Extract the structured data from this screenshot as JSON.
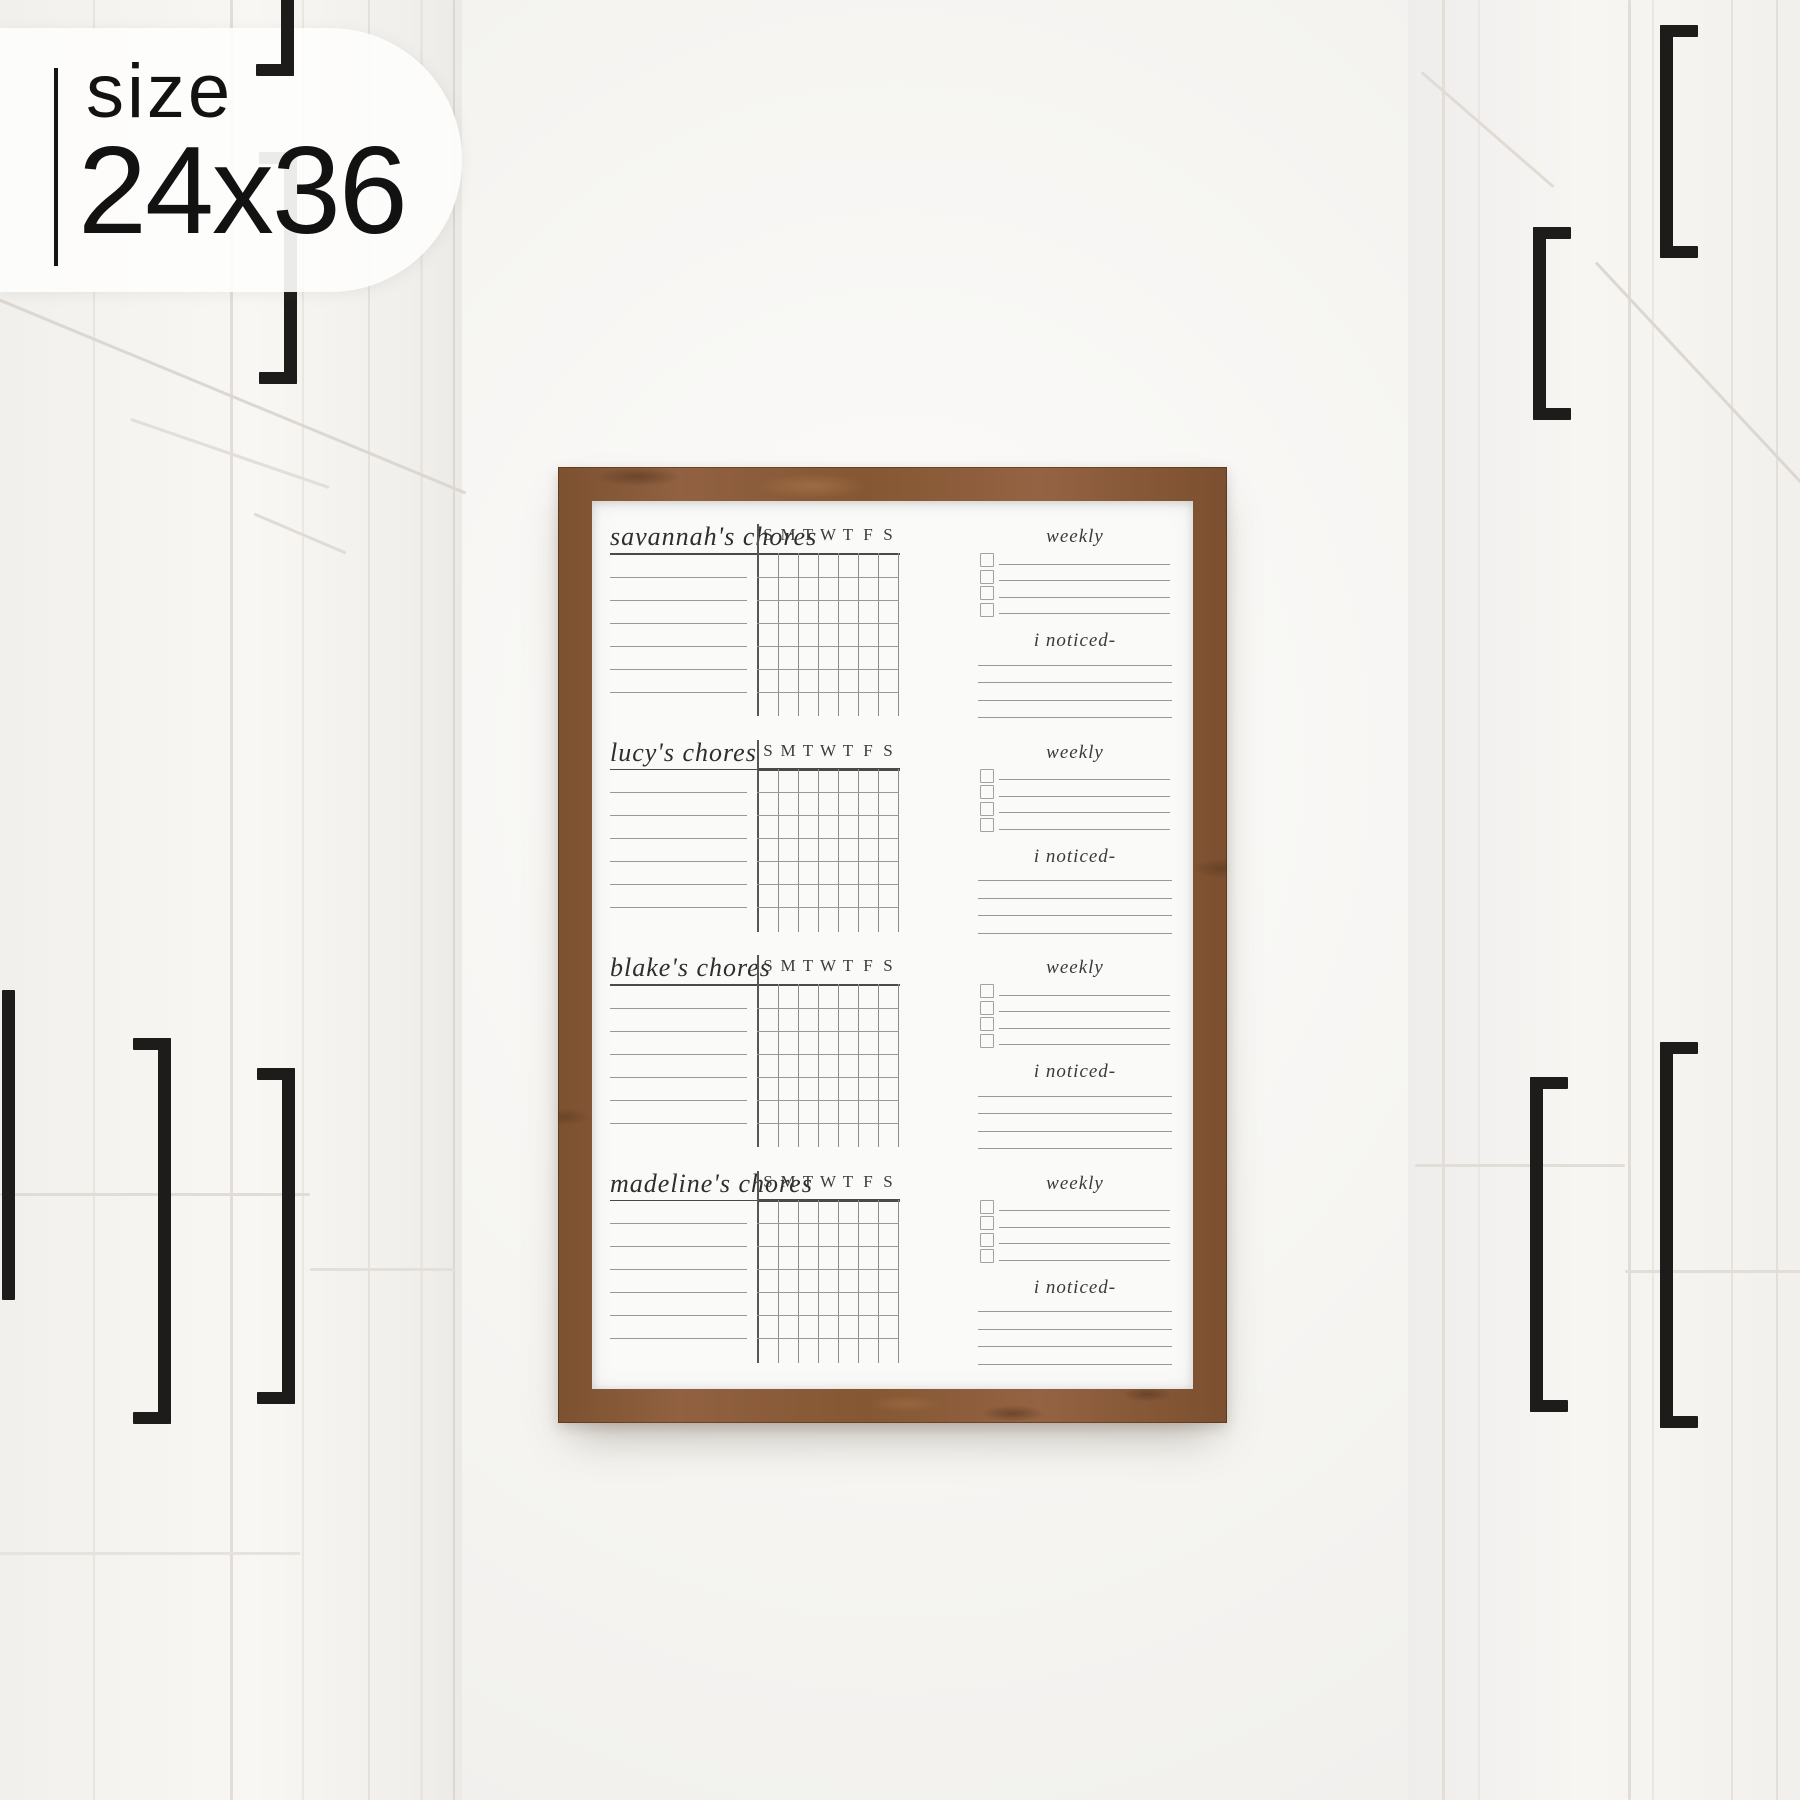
{
  "badge": {
    "label": "size",
    "value": "24x36"
  },
  "board": {
    "sections": [
      {
        "title": "savannah's chores"
      },
      {
        "title": "lucy's chores"
      },
      {
        "title": "blake's chores"
      },
      {
        "title": "madeline's chores"
      }
    ],
    "day_headers": [
      "S",
      "M",
      "T",
      "W",
      "T",
      "F",
      "S"
    ],
    "weekly_label": "weekly",
    "noticed_label": "i noticed-",
    "weekly_checkbox_rows": 4,
    "chore_lines_per_section": 6,
    "noticed_lines_per_section": 4,
    "grid_rows": 6,
    "grid_columns": 7
  },
  "colors": {
    "frame_wood": "#8a5b37",
    "board_paper": "#fafaf9",
    "ink": "#2e2e2e",
    "grid_line": "#8c8c8c",
    "handle_black": "#1d1c1a",
    "wall_white": "#f6f5f2"
  }
}
